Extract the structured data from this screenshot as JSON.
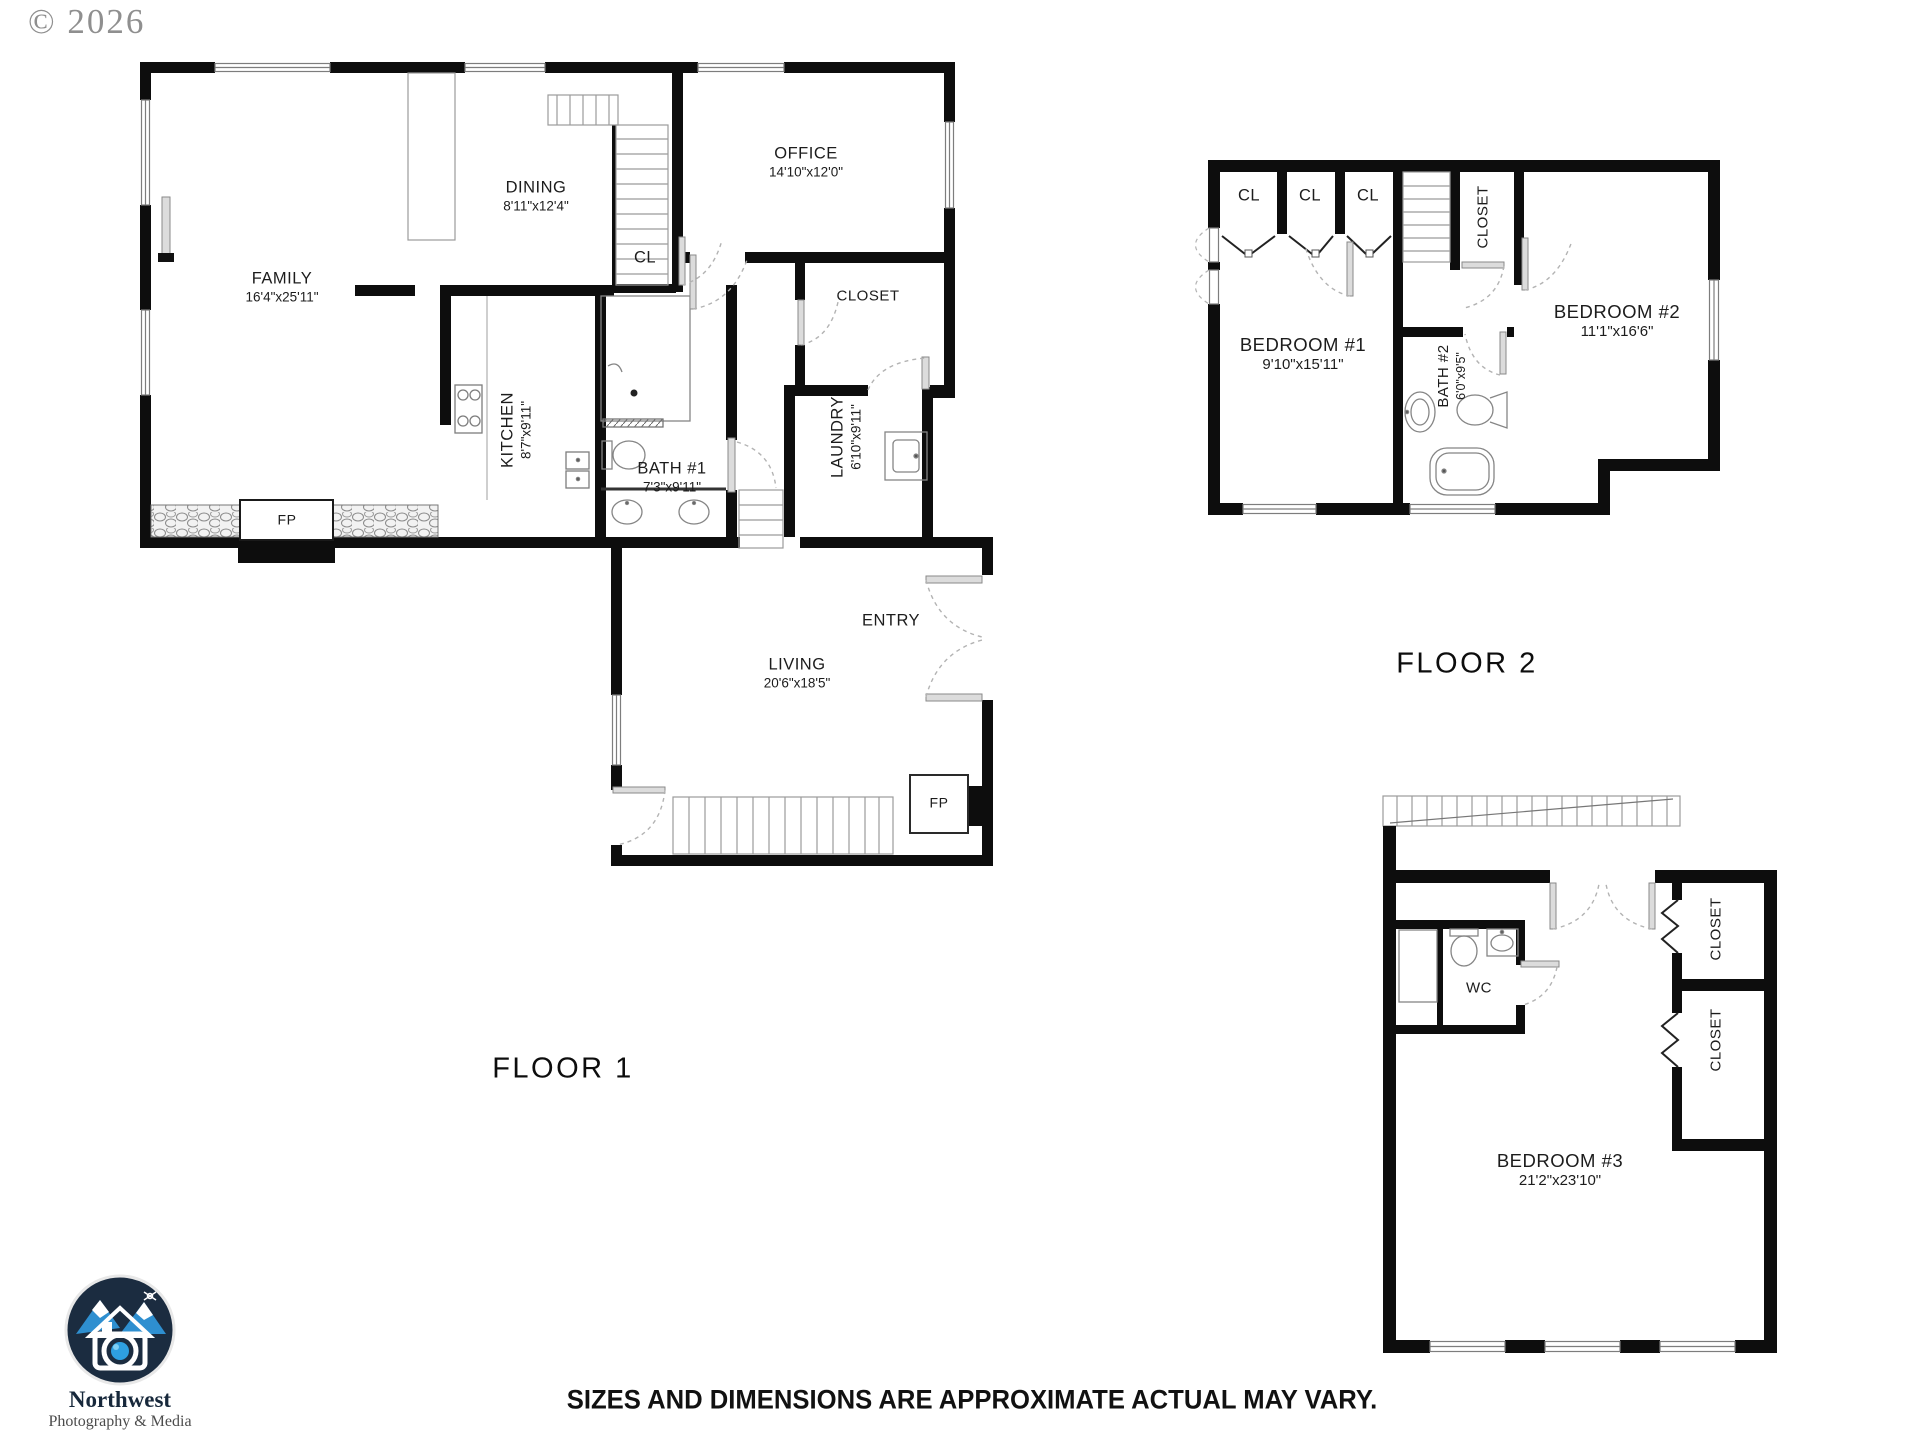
{
  "watermark": "© 2026",
  "floor1": {
    "title": "FLOOR 1",
    "rooms": {
      "family": {
        "name": "FAMILY",
        "dims": "16'4\"x25'11\""
      },
      "dining": {
        "name": "DINING",
        "dims": "8'11\"x12'4\""
      },
      "office": {
        "name": "OFFICE",
        "dims": "14'10\"x12'0\""
      },
      "closet": {
        "name": "CLOSET"
      },
      "cl": {
        "name": "CL"
      },
      "kitchen": {
        "name": "KITCHEN",
        "dims": "8'7\"x9'11\""
      },
      "bath1": {
        "name": "BATH #1",
        "dims": "7'3\"x9'11\""
      },
      "laundry": {
        "name": "LAUNDRY",
        "dims": "6'10\"x9'11\""
      },
      "entry": {
        "name": "ENTRY"
      },
      "living": {
        "name": "LIVING",
        "dims": "20'6\"x18'5\""
      },
      "fireplace_family": {
        "label": "FP"
      },
      "fireplace_living": {
        "label": "FP"
      }
    }
  },
  "floor2": {
    "title": "FLOOR 2",
    "rooms": {
      "cl1": {
        "name": "CL"
      },
      "cl2": {
        "name": "CL"
      },
      "cl3": {
        "name": "CL"
      },
      "closet": {
        "name": "CLOSET"
      },
      "bedroom1": {
        "name": "BEDROOM #1",
        "dims": "9'10\"x15'11\""
      },
      "bath2": {
        "name": "BATH #2",
        "dims": "6'0\"x9'5\""
      },
      "bedroom2": {
        "name": "BEDROOM #2",
        "dims": "11'1\"x16'6\""
      }
    }
  },
  "floor3": {
    "rooms": {
      "wc": {
        "name": "WC"
      },
      "closet_upper": {
        "name": "CLOSET"
      },
      "closet_lower": {
        "name": "CLOSET"
      },
      "bedroom3": {
        "name": "BEDROOM #3",
        "dims": "21'2\"x23'10\""
      }
    }
  },
  "logo": {
    "name": "Northwest",
    "tagline": "Photography & Media",
    "circle_color": "#1b2c40",
    "accent_color": "#2e8fd0"
  },
  "disclaimer": "SIZES AND DIMENSIONS ARE APPROXIMATE ACTUAL MAY VARY."
}
